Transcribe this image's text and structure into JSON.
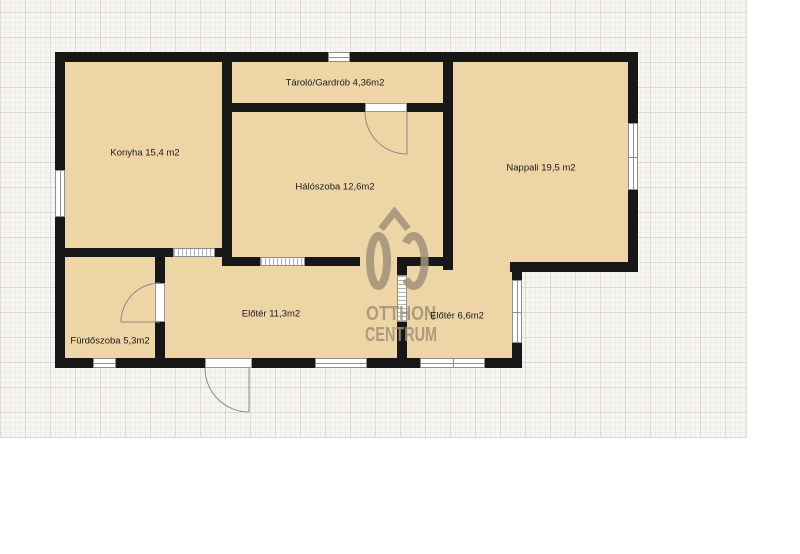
{
  "grid": {
    "x": 0,
    "y": 0,
    "width": 746,
    "height": 438
  },
  "logo": {
    "mark": "OC",
    "otthon": "OTTHON",
    "centrum": "CENTRUM",
    "color": "#a2927a"
  },
  "plan": {
    "colors": {
      "room_fill": "#eed5a6",
      "wall": "#171717",
      "window_border": "#8f8f8f",
      "door_arc": "#8a8a8a",
      "label_text": "#1b1b1b"
    },
    "fills": [
      [
        55,
        52,
        583,
        220
      ],
      [
        55,
        248,
        467,
        120
      ]
    ],
    "walls": [
      [
        55,
        52,
        583,
        10
      ],
      [
        55,
        52,
        10,
        316
      ],
      [
        55,
        358,
        467,
        10
      ],
      [
        628,
        52,
        10,
        220
      ],
      [
        510,
        262,
        128,
        10
      ],
      [
        512,
        262,
        10,
        106
      ],
      [
        222,
        52,
        10,
        205
      ],
      [
        222,
        103,
        221,
        9
      ],
      [
        443,
        52,
        10,
        218
      ],
      [
        55,
        248,
        177,
        9
      ],
      [
        155,
        248,
        10,
        120
      ],
      [
        222,
        257,
        138,
        9
      ],
      [
        397,
        257,
        50,
        9
      ],
      [
        397,
        257,
        10,
        111
      ]
    ],
    "windows": [
      {
        "rect": [
          328,
          52,
          22,
          10
        ],
        "type": "h"
      },
      {
        "rect": [
          55,
          170,
          10,
          47
        ],
        "type": "v"
      },
      {
        "rect": [
          93,
          358,
          23,
          10
        ],
        "type": "h"
      },
      {
        "rect": [
          315,
          358,
          52,
          10
        ],
        "type": "h"
      },
      {
        "rect": [
          420,
          358,
          65,
          10
        ],
        "type": "h2"
      },
      {
        "rect": [
          628,
          123,
          10,
          67
        ],
        "type": "v2"
      },
      {
        "rect": [
          512,
          280,
          10,
          63
        ],
        "type": "v2"
      }
    ],
    "hatched": [
      {
        "rect": [
          173,
          248,
          42,
          9
        ],
        "dir": "h"
      },
      {
        "rect": [
          260,
          257,
          45,
          9
        ],
        "dir": "h"
      },
      {
        "rect": [
          397,
          275,
          10,
          47
        ],
        "dir": "v"
      }
    ],
    "door_gaps": [
      [
        365,
        103,
        42,
        9
      ],
      [
        155,
        283,
        10,
        39
      ],
      [
        205,
        358,
        47,
        10
      ]
    ],
    "door_arcs": [
      {
        "arc": "M365 112 A42 42 0 0 0 407 154",
        "leaf": "M407 112 L407 154"
      },
      {
        "arc": "M160 283 A39 39 0 0 0 121 322",
        "leaf": "M160 322 L121 322"
      },
      {
        "arc": "M205 368 A44 44 0 0 0 249 412",
        "leaf": "M249 368 L249 412"
      }
    ],
    "rooms": [
      {
        "key": "konyha",
        "label": "Konyha 15,4 m2",
        "cx": 145,
        "cy": 153
      },
      {
        "key": "tarolo",
        "label": "Tároló/Gardrób 4,36m2",
        "cx": 335,
        "cy": 83
      },
      {
        "key": "haloszoba",
        "label": "Hálószoba 12,6m2",
        "cx": 335,
        "cy": 187
      },
      {
        "key": "nappali",
        "label": "Nappali 19,5 m2",
        "cx": 541,
        "cy": 168
      },
      {
        "key": "furdoszoba",
        "label": "Fürdőszoba 5,3m2",
        "cx": 110,
        "cy": 341
      },
      {
        "key": "eloter-nagy",
        "label": "Előtér 11,3m2",
        "cx": 271,
        "cy": 314
      },
      {
        "key": "eloter-kis",
        "label": "Előtér 6,6m2",
        "cx": 457,
        "cy": 316
      }
    ]
  }
}
